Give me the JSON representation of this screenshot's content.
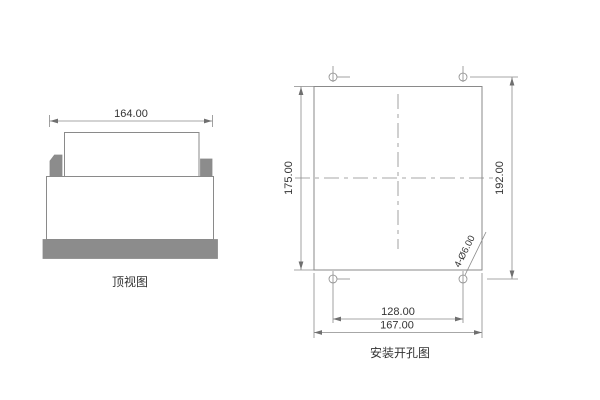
{
  "colors": {
    "background": "#ffffff",
    "line": "#8a8a8a",
    "gray_fill": "#8c8c8c",
    "arrow": "#6f6f6f",
    "text": "#333333"
  },
  "top_view": {
    "label": "顶视图",
    "dims": {
      "width": "164.00"
    }
  },
  "cutout_view": {
    "label": "安装开孔图",
    "dims": {
      "panel_height": "175.00",
      "hole_span_vertical": "192.00",
      "hole_span_horizontal": "128.00",
      "panel_width": "167.00",
      "hole_note": "4-Ø6.00"
    }
  }
}
